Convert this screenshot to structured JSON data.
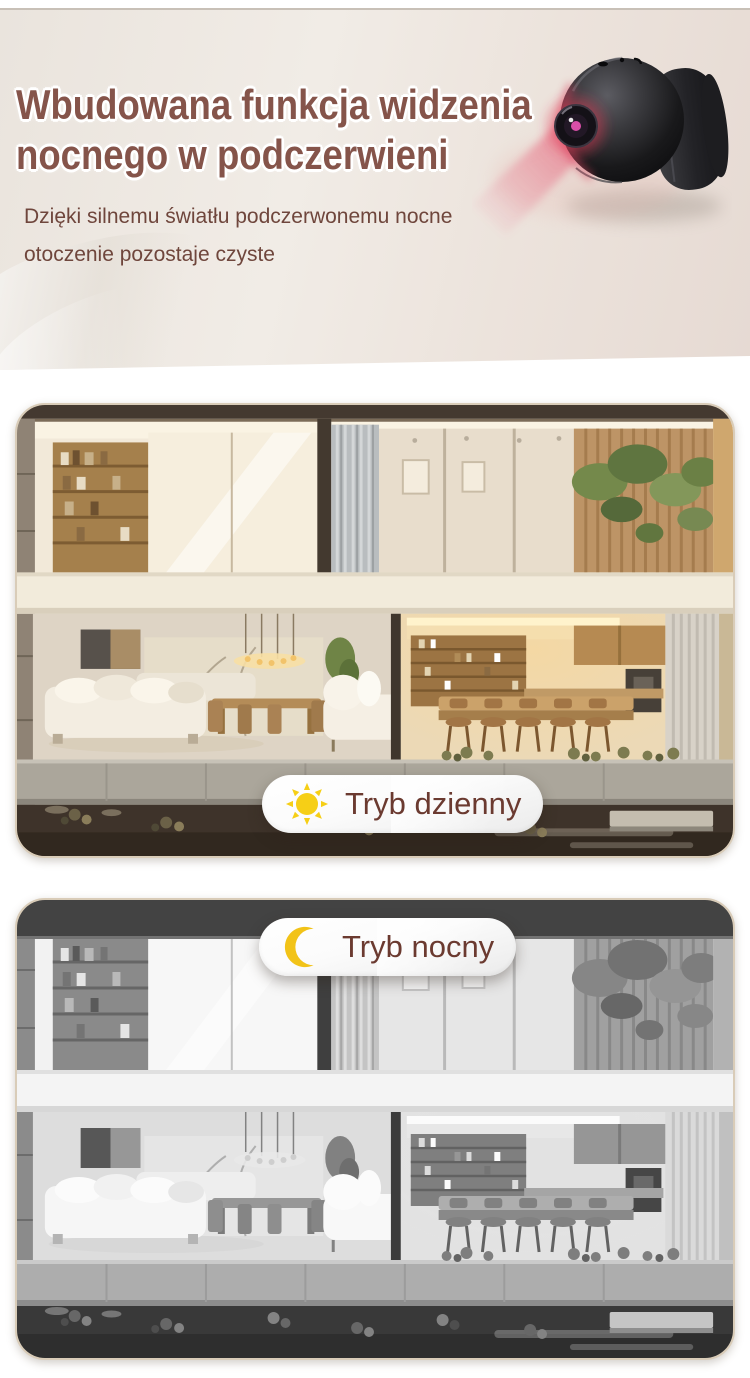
{
  "hero": {
    "title_line1": "Wbudowana funkcja widzenia",
    "title_line2": "nocnego w podczerwieni",
    "subtitle": "Dzięki silnemu światłu podczerwonemu nocne otoczenie pozostaje czyste",
    "title_color": "#85544a",
    "subtitle_color": "#6f463c",
    "background_color": "#ece5de",
    "camera_photo": "mini-wifi-camera-with-red-ir-lens-glow",
    "ir_glow_color": "#e23a55"
  },
  "modes": {
    "day": {
      "label": "Tryb dzienny",
      "icon": "sun-icon",
      "icon_color": "#f6cf16",
      "badge_position": "bottom-center",
      "image": "house-cross-section-daylight-color"
    },
    "night": {
      "label": "Tryb nocny",
      "icon": "moon-icon",
      "icon_color": "#f2c318",
      "badge_position": "top-center",
      "image": "house-cross-section-infrared-grayscale"
    }
  },
  "badge_style": {
    "text_color": "#6b3a30",
    "background_color": "#ffffff"
  },
  "card_style": {
    "border_color": "#d9ccb8",
    "corner_radius_px": 30
  }
}
